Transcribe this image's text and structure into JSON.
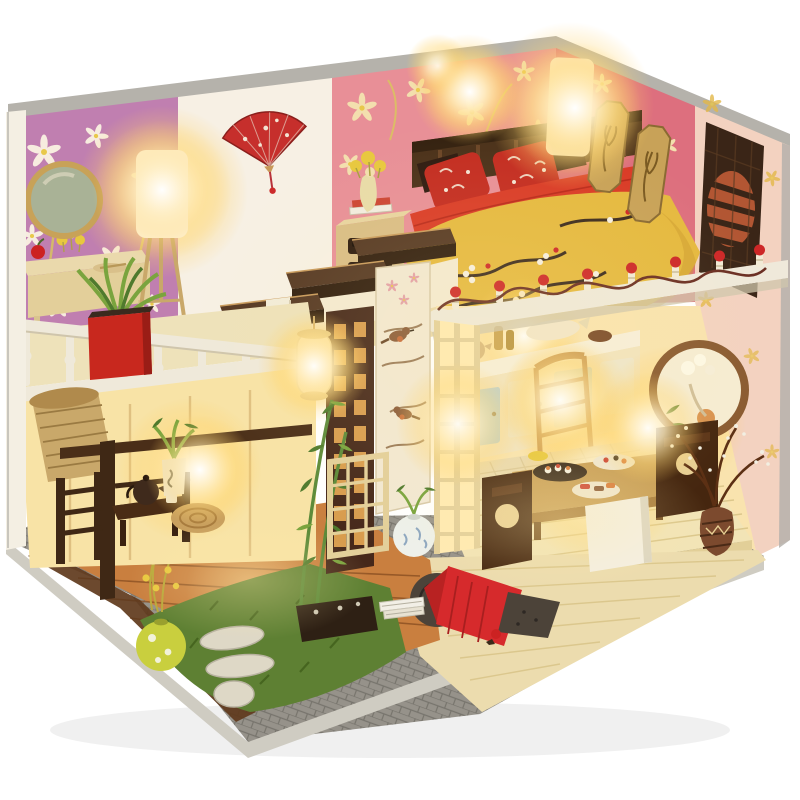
{
  "meta": {
    "image_type": "product-photo",
    "subject": "DIY miniature dollhouse diorama (two-story Japanese-style room box) with warm LED lighting on a white seamless background"
  },
  "palette": {
    "bg": "#ffffff",
    "edge_gray": "#b5b2ab",
    "base_gray": "#96928a",
    "base_side": "#cfccc2",
    "wall_white": "#f7f0e4",
    "wallpaper_purple": "#c07fb0",
    "wallpaper_pink": "#e88f97",
    "wallpaper_pink_dk": "#dd6f7e",
    "flower_white": "#f7ecdf",
    "flower_cream": "#f3dfae",
    "stem_yellow": "#d8c85a",
    "exterior_peach": "#f3d2c0",
    "grille_dark": "#3a2517",
    "grille_slat": "#b25633",
    "mirror_gold": "#c8a258",
    "mirror_glass": "#a9b296",
    "lamp_white": "#fdf6e8",
    "stairs_top": "#553823",
    "stairs_front": "#301d0e",
    "stairs_edge": "#c89a5c",
    "lattice_dark": "#46281a",
    "lattice_glow": "#e8a954",
    "lattice_cream": "#e3cf9a",
    "pane_glow": "#ffeab2",
    "shoji_cream": "#f2e8d2",
    "bird_brown": "#8a5a38",
    "railing_white": "#efe9da",
    "railing_shadow": "#cfc5ac",
    "red_ball": "#cd2727",
    "branch_dark": "#6b2f23",
    "headboard": "#4a3019",
    "pillow_red": "#c32b20",
    "blanket_red": "#d93a26",
    "quilt_yellow": "#e5b93f",
    "quilt_branch": "#3c2b1e",
    "nightstand": "#d9bd85",
    "kitchen_cream": "#f2e3bd",
    "cabinet_blue": "#b9cfd2",
    "chair_wood": "#c79653",
    "table_wood": "#c89e56",
    "zaisu_dark": "#45260f",
    "box_white": "#f4efe2",
    "vase_brown": "#7c4a2e",
    "futon_red": "#d62a2c",
    "futon_dark": "#4c4339",
    "porcelain": "#eef0ea",
    "porcelain_blue": "#7d9ab8",
    "plant_green": "#4f7a2d",
    "plant_light": "#7aa43e",
    "bamboo_green": "#5c8a39",
    "vase_yellow": "#c9cf3e",
    "flower_yellow": "#e8c83e",
    "rug_tan": "#c9a05e",
    "blind_tan": "#c9a86a",
    "blind_dark": "#9a7a42",
    "pot_white": "#eee8d8",
    "teapot_dark": "#3f2a1c",
    "apple_red": "#cc2222",
    "interior_warm": "#f9e3ae",
    "deck_wood": "#c97f3f",
    "deck_dark": "#8a4f22",
    "deck_edge": "#5f3a1c",
    "tatami": "#f2e4b6",
    "tatami_line": "#d9c488",
    "floor_beige": "#ecdcae",
    "grass": "#5e8033",
    "grass_dark": "#46651f",
    "stone_light": "#ded8c6",
    "fan_red": "#c62f2c"
  },
  "scene": {
    "setting": "white seamless studio background",
    "base": "gray carved stone-texture platform with beveled light edge",
    "right_wall": [
      "peach exterior with gold flower print",
      "dark carved lattice vent window with round slatted center"
    ],
    "upper_floor": {
      "left_loft": [
        "pink-purple floral wallpaper",
        "gold-rim round mirror",
        "vanity table with red apple and flowers",
        "glowing tripod floor lamp",
        "white turned-post balcony railing",
        "red planter with green plant"
      ],
      "bedroom": [
        "pink floral wallpaper",
        "red folding fan on white wall",
        "dark slatted headboard",
        "red patterned pillows",
        "red knit blanket",
        "yellow quilt with plum-branch print",
        "wood nightstand with books and flower vase",
        "two glowing white lamps",
        "two gold octagonal wall plaques",
        "white deck edge with red-berry finial railing"
      ]
    },
    "lower_floor": {
      "kitchen": [
        "cream and blue cabinet fronts",
        "counter with bottles, kettle and dishes",
        "ladder-back chair",
        "glowing lamp"
      ],
      "dining": [
        "low wooden table with sushi trays",
        "two dark floor chairs (zaisu)",
        "white storage box",
        "patterned brown vase with dried branches and baby's breath",
        "round wood-framed wall mirror with flowers and fruit"
      ],
      "porch": [
        "bamboo roller blind",
        "dark wood pergola post and railing",
        "tea bench with dark teapot and cup",
        "round woven rug",
        "potted plant"
      ],
      "passage": [
        "floating dark stairs",
        "hanging glowing white lantern",
        "dark lattice screen",
        "shoji panel painted with birds",
        "glowing cream lattice door",
        "bamboo plant in dark planter",
        "blue-and-white porcelain ball vase",
        "rolled futon with red cover",
        "stacked books on floor"
      ]
    },
    "garden": [
      "green grass patch",
      "two stepping stones",
      "round stone",
      "yellow ball vase with yellow flower sprays"
    ]
  }
}
